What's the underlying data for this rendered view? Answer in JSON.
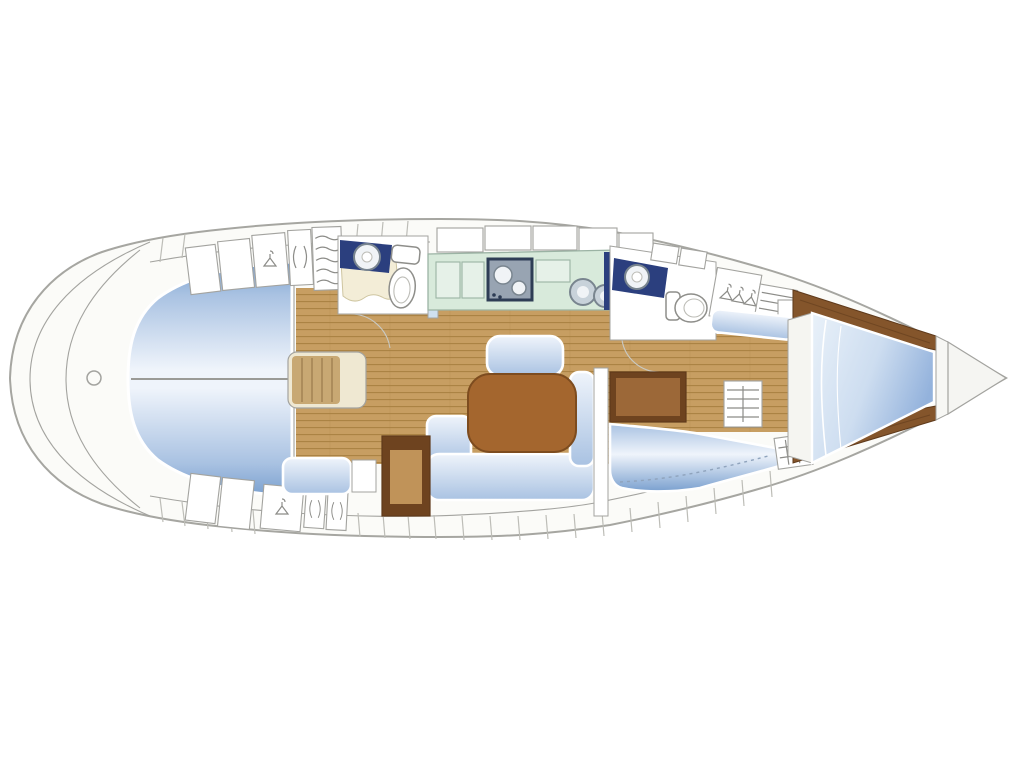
{
  "title": "Sailing yacht interior layout plan (top view, bow to the right)",
  "palette": {
    "hull_fill": "#FBFBF8",
    "hull_line": "#A6A6A1",
    "outline": "#A3A39F",
    "seam": "#BDBDB7",
    "sym": "#8C8C88",
    "white": "#FFFFFF",
    "wood_floor": "#C79E62",
    "wood_floor_line": "#A77F3F",
    "wood_dark": "#6E431F",
    "wood_dark_inner": "#9C6838",
    "nav_inner": "#C09359",
    "wood_shelf": "#84552B",
    "wood_shelf_dark": "#5F3A1B",
    "table": "#A4662E",
    "table_dark": "#7D4C1F",
    "steps_tan": "#C8A873",
    "steps_cream": "#EFE8D2",
    "steps_line": "#9A7B4B",
    "cushion_deep": "#7AA0CF",
    "cushion_mid": "#A9C2E2",
    "cushion_light": "#EFF4FB",
    "navy": "#2B3F7E",
    "mint": "#D8EADB",
    "mint_cell": "#E6F1E8",
    "mint_line": "#9BB3A4",
    "stove_frame": "#2E3D55",
    "stove_body": "#98A4B2",
    "metal": "#C8D2DA",
    "metal_rim": "#79858F",
    "metal_light": "#F0F3F6",
    "cream": "#F3EDD7",
    "cream_line": "#CEC5A0",
    "door_blue": "#CFE0EF",
    "door_arc": "#C9C9C3",
    "fixture_line": "#8E8E8A",
    "dash_blue": "#8FA3BC",
    "divider": "#9A9A96"
  },
  "areas": [
    {
      "id": "hull-outline",
      "label": "hull outline, bow pointing right"
    },
    {
      "id": "transom",
      "label": "rounded stern / transom with lazarette arcs"
    },
    {
      "id": "rudder-post",
      "label": "rudder post fitting at stern"
    },
    {
      "id": "aft-berths",
      "label": "two aft double berths split on centerline"
    },
    {
      "id": "aft-cabin-lockers",
      "label": "aft cabin wardrobes with hanger symbols"
    },
    {
      "id": "companionway-steps",
      "label": "companionway steps on centerline"
    },
    {
      "id": "aft-head",
      "label": "aft head: WC, basin on navy counter, shower pan"
    },
    {
      "id": "saloon",
      "label": "saloon with wood plank sole"
    },
    {
      "id": "saloon-table",
      "label": "saloon dining table"
    },
    {
      "id": "u-settee",
      "label": "U-shaped settee around table"
    },
    {
      "id": "center-bench",
      "label": "centerline bench seat"
    },
    {
      "id": "side-bench",
      "label": "small side bench"
    },
    {
      "id": "nav-station",
      "label": "navigation / chart locker block"
    },
    {
      "id": "galley",
      "label": "in-line galley: counters, 2-burner stove, twin round sinks"
    },
    {
      "id": "forward-head",
      "label": "forward head: WC and basin on navy counter"
    },
    {
      "id": "forward-wardrobes",
      "label": "forward hanging locker and shelf locker"
    },
    {
      "id": "forward-dresser",
      "label": "drawer unit by forward cabins"
    },
    {
      "id": "forward-starboard-berth",
      "label": "forward starboard double berth"
    },
    {
      "id": "bow-v-berth",
      "label": "bow V-berth with hull shelves"
    },
    {
      "id": "anchor-locker",
      "label": "anchor locker at bow tip"
    }
  ]
}
